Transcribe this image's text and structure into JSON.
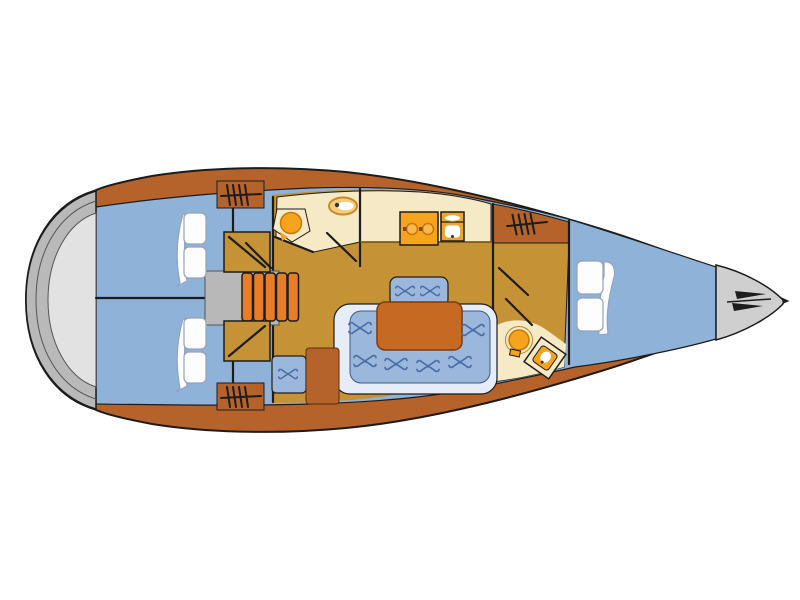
{
  "diagram": {
    "type": "yacht-interior-floor-plan",
    "orientation": "bow-right",
    "legend": [
      "stern-swim-platform",
      "aft-cabin-port",
      "aft-cabin-starboard",
      "hanging-locker-port",
      "hanging-locker-starboard",
      "companionway-steps",
      "aft-head",
      "washbasin",
      "toilet",
      "galley",
      "stove",
      "double-sink",
      "saloon",
      "settee",
      "saloon-table",
      "chart-table-block",
      "forward-head",
      "shower",
      "hanging-locker-forward",
      "v-berth-cabin",
      "anchor-locker"
    ]
  },
  "colors": {
    "background": "#ffffff",
    "hull_wood": "#b5632b",
    "outline": "#1c1c1c",
    "cabin_floor_blue": "#8fb2d8",
    "saloon_floor_gold": "#c59235",
    "wet_floor_cream": "#f6e9c5",
    "fixture_orange": "#f6a31d",
    "burner_orange": "#f9b850",
    "steps_orange": "#e87d28",
    "table_wood": "#c66a23",
    "settee_blue": "#9bb7dc",
    "settee_trim": "#e6edf8",
    "tuft_blue": "#4a6da8",
    "transom_gray": "#b9b9b9",
    "transom_gray_light": "#e2e2e2",
    "bow_gray": "#cfcfcf",
    "engine_box_gray": "#b8b8b8",
    "bed_white": "#fdfdfd",
    "toilet_cream": "#f3cf7d",
    "toilet_rim": "#c98a2a",
    "anchor_dark": "#1d1d1d",
    "white": "#ffffff"
  }
}
